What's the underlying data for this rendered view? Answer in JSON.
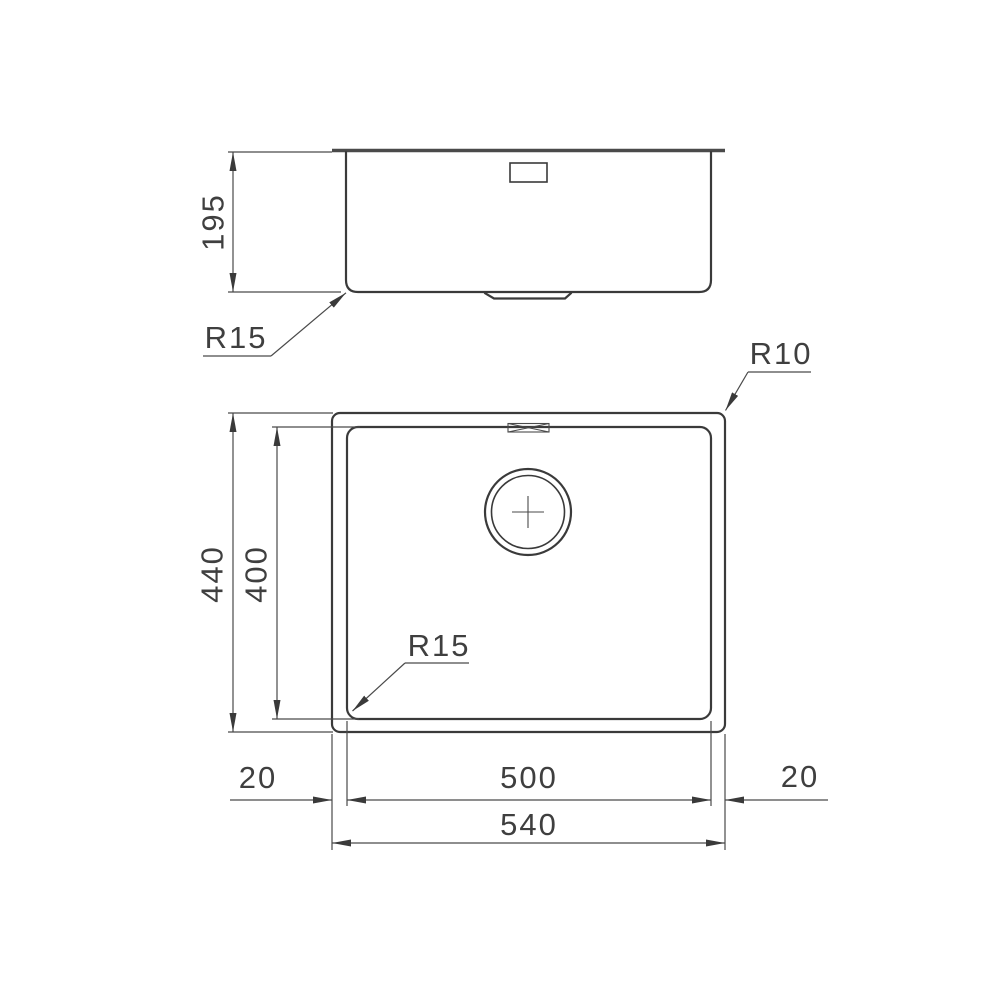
{
  "drawing": {
    "side_view": {
      "depth": "195",
      "bottom_radius": "R15"
    },
    "plan_view": {
      "outer_corner_radius": "R10",
      "bowl_corner_radius": "R15",
      "outer_height": "440",
      "bowl_height": "400",
      "bowl_width": "500",
      "outer_width": "540",
      "rim_left": "20",
      "rim_right": "20"
    }
  }
}
